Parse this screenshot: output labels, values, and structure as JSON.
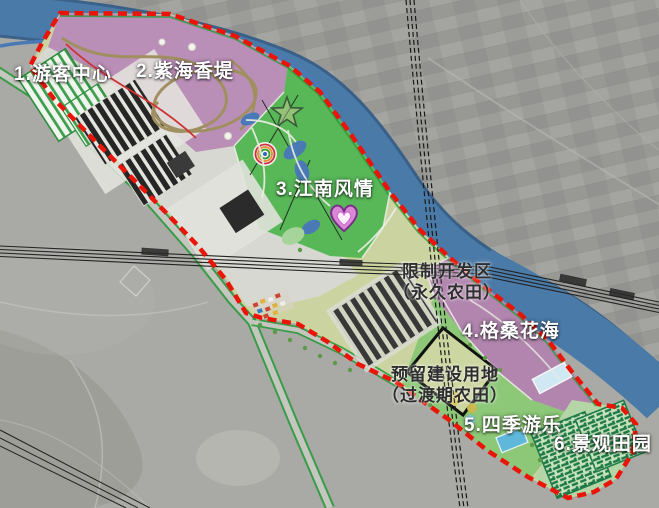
{
  "map": {
    "type": "tourism-master-plan-over-satellite",
    "boundary_color": "#ea1408",
    "river_color": "#4a7aa8",
    "farmland_color": "#cbd4a0",
    "road_edge_color": "#2c9a3e"
  },
  "zones": [
    {
      "num": "1",
      "label": "1.游客中心",
      "color": "#d8d8d2"
    },
    {
      "num": "2",
      "label": "2.紫海香堤",
      "color": "#ba8fb7"
    },
    {
      "num": "3",
      "label": "3.江南风情",
      "color": "#58b858"
    },
    {
      "num": "4",
      "label": "4.格桑花海",
      "color": "#b185ae"
    },
    {
      "num": "5",
      "label": "5.四季游乐",
      "color": "#8cc878"
    },
    {
      "num": "6",
      "label": "6.景观田园",
      "color": "#2e7d4f"
    }
  ],
  "annotations": {
    "restricted": {
      "line1": "限制开发区",
      "line2": "（永久农田）"
    },
    "reserved": {
      "line1": "预留建设用地",
      "line2": "（过渡期农田）"
    }
  }
}
